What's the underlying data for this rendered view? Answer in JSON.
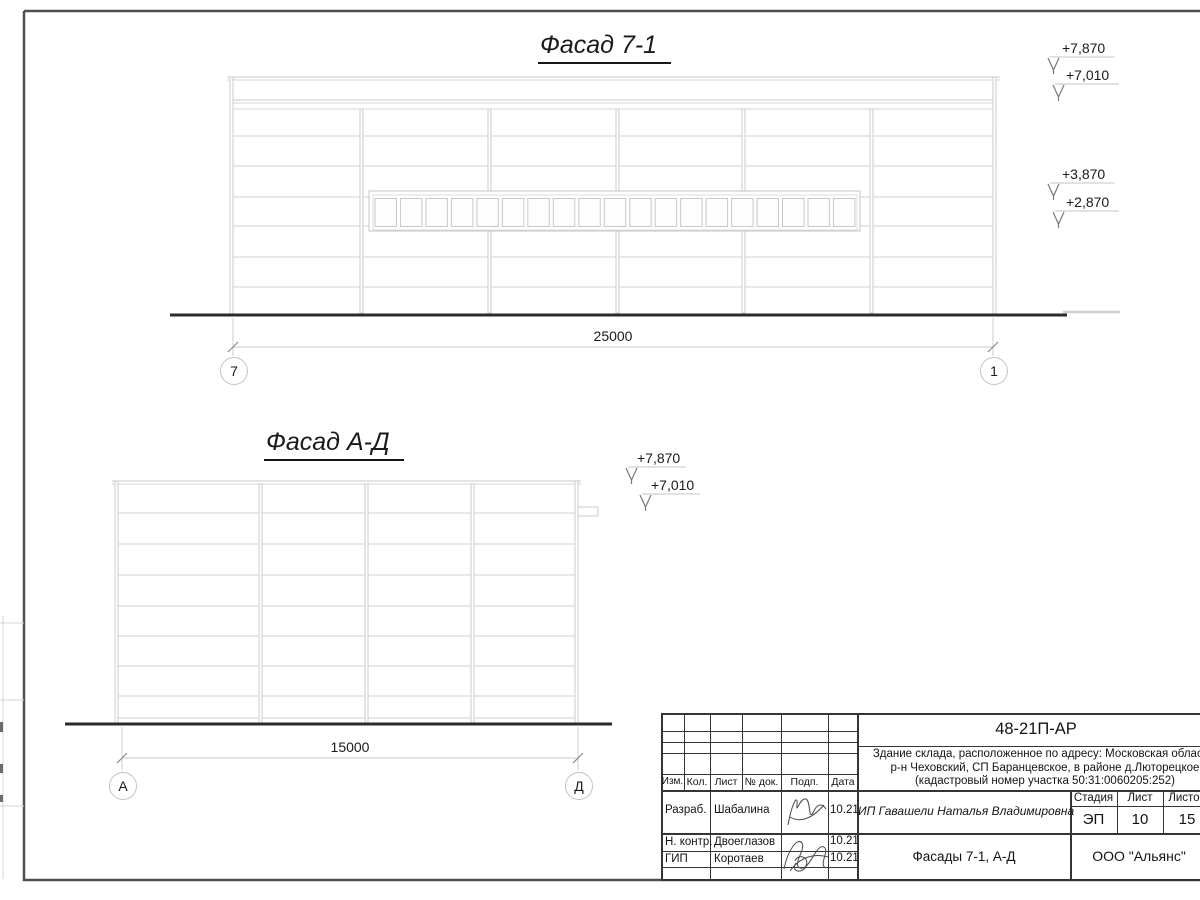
{
  "colors": {
    "line_light": "#cfcfcf",
    "line_dark": "#2b2b2b",
    "frame": "#4f4f4f",
    "text": "#1a1a1a"
  },
  "facade1": {
    "title": "Фасад 7-1",
    "dimension": "25000",
    "axis_left": "7",
    "axis_right": "1",
    "elev_1": "+7,870",
    "elev_2": "+7,010",
    "elev_3": "+3,870",
    "elev_4": "+2,870"
  },
  "facade2": {
    "title": "Фасад А-Д",
    "dimension": "15000",
    "axis_left": "А",
    "axis_right": "Д",
    "elev_1": "+7,870",
    "elev_2": "+7,010"
  },
  "title_block": {
    "doc_number": "48-21П-АР",
    "description_line1": "Здание склада, расположенное по адресу: Московская область,",
    "description_line2": "р-н Чеховский, СП Баранцевское, в районе д.Люторецкое",
    "description_line3": "(кадастровый номер участка 50:31:0060205:252)",
    "col_izm": "Изм.",
    "col_kol": "Кол.",
    "col_list": "Лист",
    "col_doc": "№ док.",
    "col_podp": "Подп.",
    "col_data": "Дата",
    "row1_role": "Разраб.",
    "row1_name": "Шабалина",
    "row1_date": "10.21",
    "row2_role": "Н. контр.",
    "row2_name": "Двоеглазов",
    "row2_date": "10.21",
    "row3_role": "ГИП",
    "row3_name": "Коротаев",
    "row3_date": "10.21",
    "client": "ИП Гавашели Наталья Владимировна",
    "stage_label": "Стадия",
    "sheet_label": "Лист",
    "sheets_label": "Листов",
    "stage": "ЭП",
    "sheet_number": "10",
    "sheets_total": "15",
    "drawing_title": "Фасады 7-1, А-Д",
    "organization": "ООО \"Альянс\""
  }
}
